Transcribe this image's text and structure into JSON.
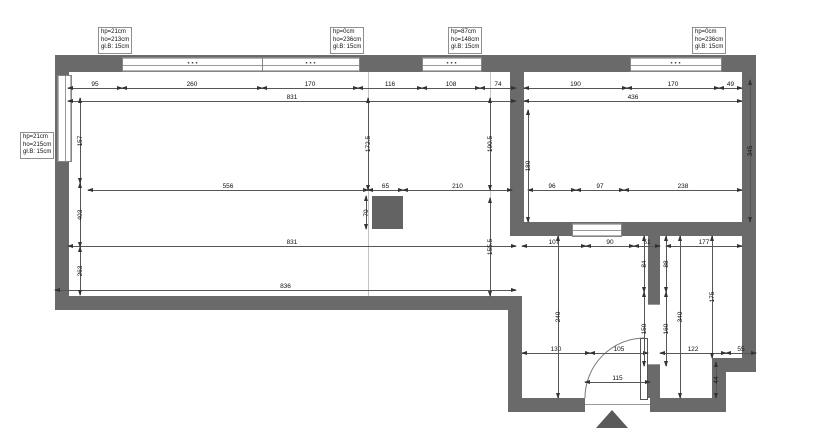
{
  "document": {
    "type": "architectural floor plan"
  },
  "colors": {
    "wall": "#6a6a6a",
    "dim_line": "#565656",
    "text": "#101010",
    "background": "#ffffff"
  },
  "annotations": {
    "window_dots": "···",
    "boxes": [
      {
        "lines": [
          "hp=21cm",
          "ho=213cm",
          "gł.B: 15cm"
        ]
      },
      {
        "lines": [
          "hp=0cm",
          "ho=236cm",
          "gł.B: 15cm"
        ]
      },
      {
        "lines": [
          "hp=87cm",
          "ho=148cm",
          "gł.B: 15cm"
        ]
      },
      {
        "lines": [
          "hp=0cm",
          "ho=236cm",
          "gł.B: 15cm"
        ]
      },
      {
        "lines": [
          "hp=21cm",
          "ho=215cm",
          "gł.B: 15cm"
        ]
      }
    ]
  },
  "dimensions": {
    "horizontal": [
      {
        "label": "95",
        "x": 68,
        "y": 88,
        "w": 54
      },
      {
        "label": "260",
        "x": 122,
        "y": 88,
        "w": 140
      },
      {
        "label": "170",
        "x": 262,
        "y": 88,
        "w": 96
      },
      {
        "label": "116",
        "x": 358,
        "y": 88,
        "w": 64
      },
      {
        "label": "108",
        "x": 422,
        "y": 88,
        "w": 58
      },
      {
        "label": "74",
        "x": 480,
        "y": 88,
        "w": 36
      },
      {
        "label": "190",
        "x": 524,
        "y": 88,
        "w": 103
      },
      {
        "label": "170",
        "x": 627,
        "y": 88,
        "w": 92
      },
      {
        "label": "49",
        "x": 719,
        "y": 88,
        "w": 23
      },
      {
        "label": "831",
        "x": 68,
        "y": 101,
        "w": 448
      },
      {
        "label": "436",
        "x": 524,
        "y": 101,
        "w": 218
      },
      {
        "label": "556",
        "x": 88,
        "y": 190,
        "w": 280
      },
      {
        "label": "65",
        "x": 368,
        "y": 190,
        "w": 35
      },
      {
        "label": "210",
        "x": 403,
        "y": 190,
        "w": 109
      },
      {
        "label": "96",
        "x": 528,
        "y": 190,
        "w": 48
      },
      {
        "label": "97",
        "x": 576,
        "y": 190,
        "w": 48
      },
      {
        "label": "238",
        "x": 624,
        "y": 190,
        "w": 118
      },
      {
        "label": "831",
        "x": 68,
        "y": 246,
        "w": 448
      },
      {
        "label": "107",
        "x": 522,
        "y": 246,
        "w": 64
      },
      {
        "label": "90",
        "x": 586,
        "y": 246,
        "w": 48
      },
      {
        "label": "51",
        "x": 634,
        "y": 246,
        "w": 26
      },
      {
        "label": "177",
        "x": 666,
        "y": 246,
        "w": 76
      },
      {
        "label": "836",
        "x": 55,
        "y": 290,
        "w": 461
      },
      {
        "label": "130",
        "x": 522,
        "y": 353,
        "w": 68
      },
      {
        "label": "105",
        "x": 590,
        "y": 353,
        "w": 58
      },
      {
        "label": "122",
        "x": 660,
        "y": 353,
        "w": 66
      },
      {
        "label": "55",
        "x": 726,
        "y": 353,
        "w": 30
      },
      {
        "label": "115",
        "x": 585,
        "y": 382,
        "w": 65
      }
    ],
    "vertical": [
      {
        "label": "157",
        "x": 80,
        "y": 98,
        "h": 85
      },
      {
        "label": "403",
        "x": 80,
        "y": 183,
        "h": 64
      },
      {
        "label": "263",
        "x": 80,
        "y": 247,
        "h": 48
      },
      {
        "label": "172.5",
        "x": 368,
        "y": 98,
        "h": 92
      },
      {
        "label": "190.5",
        "x": 490,
        "y": 98,
        "h": 92
      },
      {
        "label": "180",
        "x": 528,
        "y": 110,
        "h": 112
      },
      {
        "label": "155.5",
        "x": 490,
        "y": 198,
        "h": 98
      },
      {
        "label": "70",
        "x": 366,
        "y": 196,
        "h": 33
      },
      {
        "label": "345",
        "x": 750,
        "y": 80,
        "h": 142
      },
      {
        "label": "240",
        "x": 558,
        "y": 236,
        "h": 162
      },
      {
        "label": "84",
        "x": 644,
        "y": 236,
        "h": 56
      },
      {
        "label": "88",
        "x": 666,
        "y": 236,
        "h": 56
      },
      {
        "label": "150",
        "x": 644,
        "y": 292,
        "h": 74
      },
      {
        "label": "160",
        "x": 666,
        "y": 292,
        "h": 74
      },
      {
        "label": "340",
        "x": 680,
        "y": 236,
        "h": 162
      },
      {
        "label": "175",
        "x": 712,
        "y": 236,
        "h": 122
      },
      {
        "label": "44",
        "x": 716,
        "y": 362,
        "h": 36
      }
    ]
  }
}
